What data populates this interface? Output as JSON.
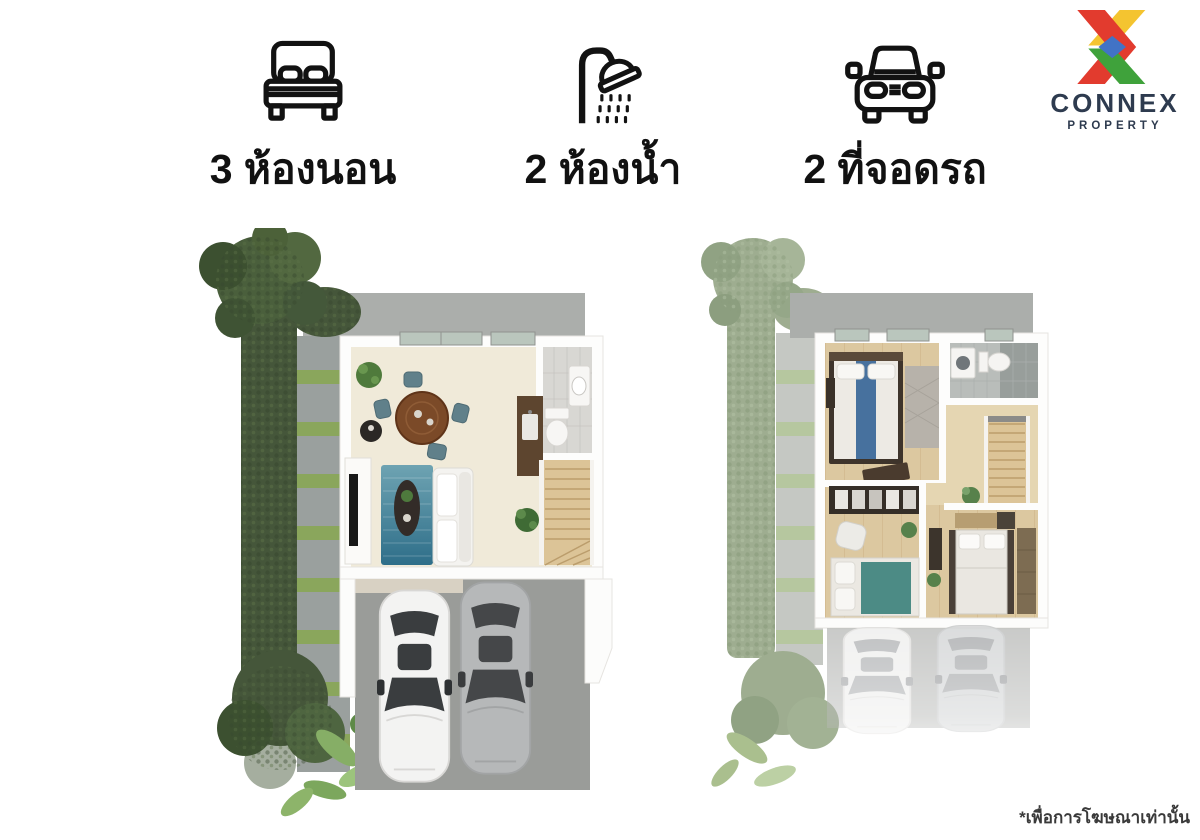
{
  "features": {
    "items": [
      {
        "icon": "bed-icon",
        "label": "3 ห้องนอน"
      },
      {
        "icon": "shower-icon",
        "label": "2 ห้องน้ำ"
      },
      {
        "icon": "car-icon",
        "label": "2 ที่จอดรถ"
      }
    ]
  },
  "logo": {
    "name": "CONNEX",
    "subtitle": "PROPERTY",
    "colors": {
      "red": "#E23B2E",
      "yellow": "#F4C430",
      "green": "#3FA23B",
      "blue": "#4173C6",
      "navy": "#2E3B4F"
    }
  },
  "plans": {
    "palette": {
      "concrete": "#ABAEAB",
      "garage_slab": "#9A9C99",
      "floor_cream": "#F0EAD9",
      "floor_wood": "#DCC8A0",
      "hedge_green": "#45563A",
      "hedge_faded": "#9EAD90",
      "grass": "#86A25C",
      "rug_blue": "#2F6E89",
      "stair_wood": "#DCC497",
      "car_white": "#F3F3F2",
      "car_gray": "#B6B8B9"
    }
  },
  "footer": {
    "disclaimer": "*เพื่อการโฆษณาเท่านั้น"
  }
}
